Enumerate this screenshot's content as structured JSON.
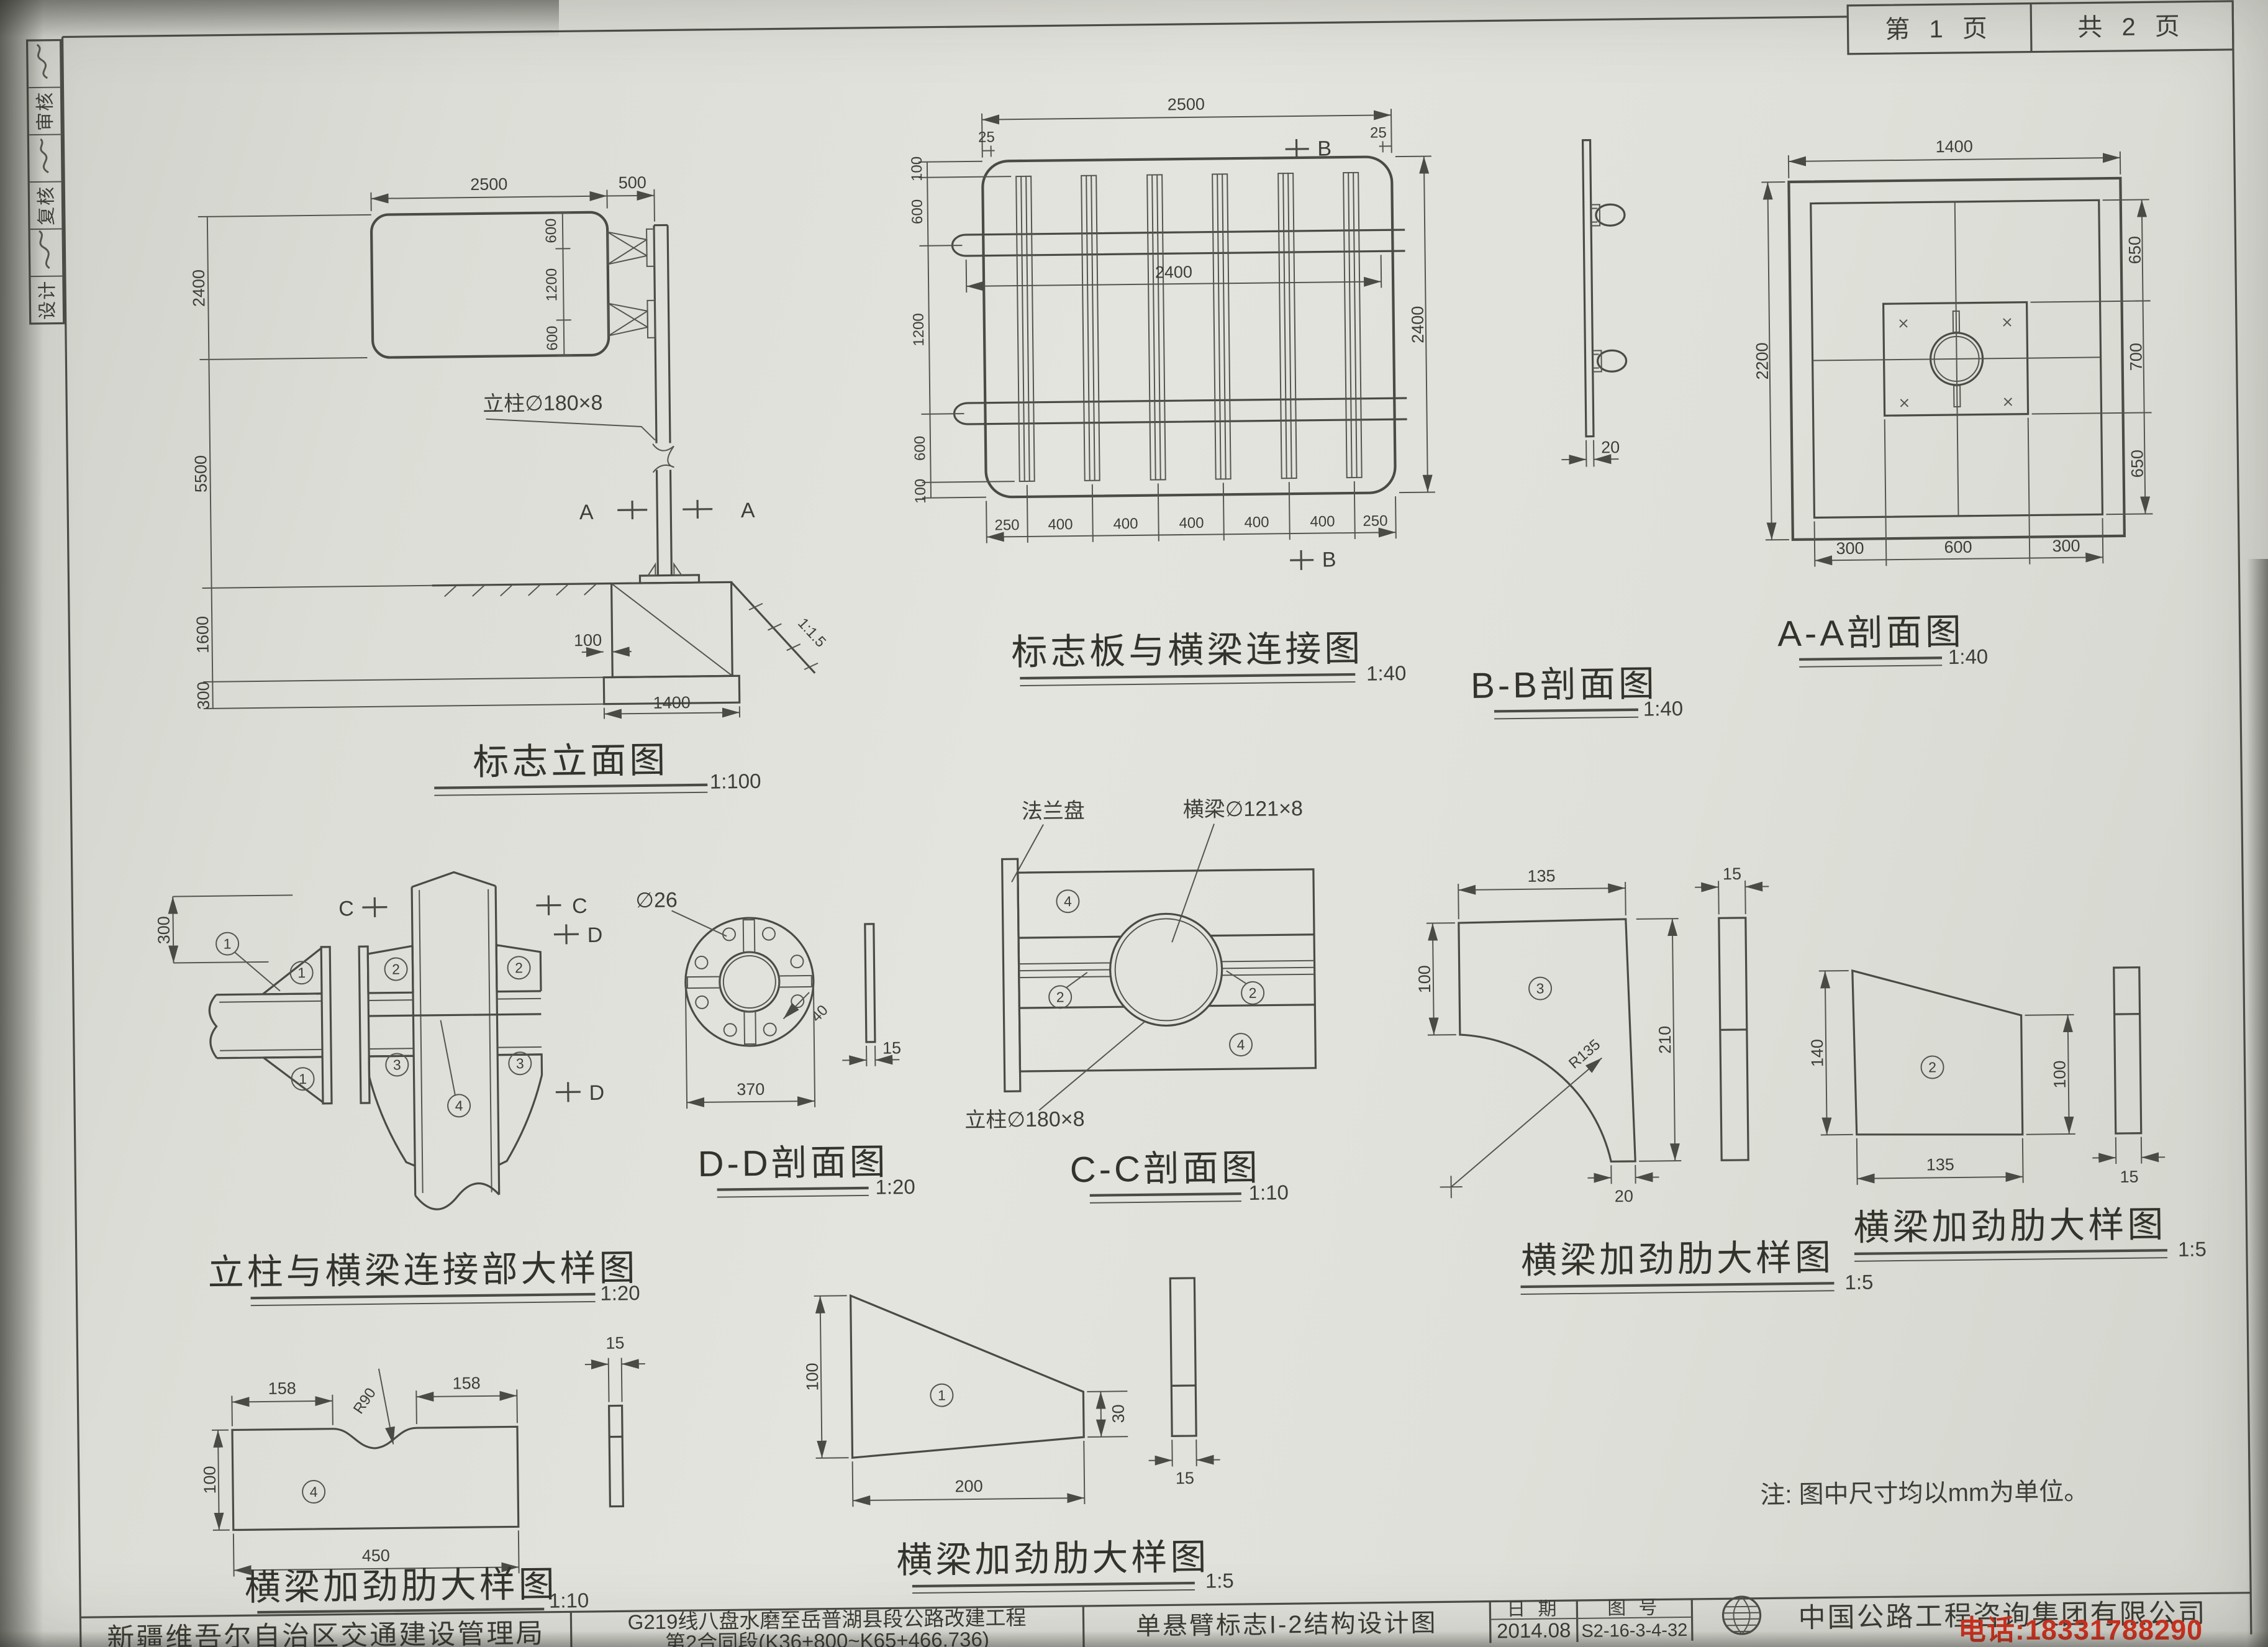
{
  "page": {
    "page_no": "第 1 页",
    "page_total": "共 2 页"
  },
  "approval": {
    "design": "设计",
    "recheck": "复核",
    "review": "审核"
  },
  "shared": {
    "balloon1": "1",
    "balloon2": "2",
    "balloon3": "3",
    "balloon4": "4",
    "markA": "A",
    "markB": "B",
    "markC": "C",
    "markD": "D"
  },
  "elevation": {
    "title": "标志立面图",
    "scale": "1:100",
    "dim_panel_w": "2500",
    "dim_offset": "500",
    "dim_sign_h": "2400",
    "dim_post_h": "5500",
    "dim_found_d": "1600",
    "dim_slab": "300",
    "dim_600a": "600",
    "dim_1200": "1200",
    "dim_600b": "600",
    "post_label": "立柱∅180×8",
    "dim_100": "100",
    "dim_1400": "1400",
    "slope": "1:1.5"
  },
  "panel_conn": {
    "title": "标志板与横梁连接图",
    "scale": "1:40",
    "dim_w": "2500",
    "dim_25l": "25",
    "dim_25r": "25",
    "dim_beam": "2400",
    "dim_h": "2400",
    "left_chain": [
      "100",
      "600",
      "1200",
      "600",
      "100"
    ],
    "bottom_chain": [
      "250",
      "400",
      "400",
      "400",
      "400",
      "400",
      "250"
    ]
  },
  "bb": {
    "title": "B-B剖面图",
    "scale": "1:40",
    "dim_t": "20"
  },
  "aa": {
    "title": "A-A剖面图",
    "scale": "1:40",
    "dim_w": "1400",
    "dim_h": "2200",
    "right_chain": [
      "650",
      "700",
      "650"
    ],
    "bottom_chain": [
      "300",
      "600",
      "300"
    ]
  },
  "conn": {
    "title": "立柱与横梁连接部大样图",
    "scale": "1:20",
    "dim_300": "300"
  },
  "dd": {
    "title": "D-D剖面图",
    "scale": "1:20",
    "hole": "∅26",
    "dim_40": "40",
    "dim_370": "370",
    "dim_15": "15"
  },
  "cc": {
    "title": "C-C剖面图",
    "scale": "1:10",
    "flange": "法兰盘",
    "beam": "横梁∅121×8",
    "post": "立柱∅180×8"
  },
  "rib3": {
    "title": "横梁加劲肋大样图",
    "scale": "1:5",
    "d135": "135",
    "d100": "100",
    "d210": "210",
    "r": "R135",
    "d20": "20",
    "d15": "15"
  },
  "rib2": {
    "title": "横梁加劲肋大样图",
    "scale": "1:5",
    "d140": "140",
    "d100": "100",
    "d135": "135",
    "d15": "15"
  },
  "rib4": {
    "title": "横梁加劲肋大样图",
    "scale": "1:10",
    "d158a": "158",
    "d158b": "158",
    "r": "R90",
    "d100": "100",
    "d450": "450",
    "d15": "15"
  },
  "rib1": {
    "title": "横梁加劲肋大样图",
    "scale": "1:5",
    "d100": "100",
    "d30": "30",
    "d200": "200",
    "d15": "15"
  },
  "note": "注: 图中尺寸均以mm为单位。",
  "titleblock": {
    "org": "新疆维吾尔自治区交通建设管理局",
    "project_line1": "G219线八盘水磨至岳普湖县段公路改建工程",
    "project_line2": "第2合同段(K36+800~K65+466.736)",
    "sheet_title": "单悬臂标志I-2结构设计图",
    "date_label": "日 期",
    "date_value": "2014.08",
    "no_label": "图 号",
    "no_value": "S2-16-3-4-32",
    "company": "中国公路工程咨询集团有限公司"
  },
  "watermark": "电话:18331788290"
}
